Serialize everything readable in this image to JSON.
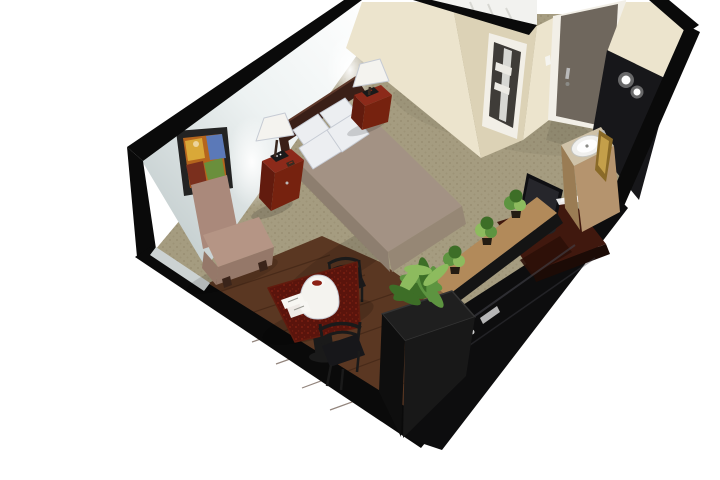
{
  "meta": {
    "title": "Isometric 3D cutaway rendering of a hotel guest room",
    "type": "3d-room-render"
  },
  "scene": {
    "description": "Top-down isometric cutaway of a hotel studio room: bed with headboard and lamps, lounge chair, framed art, dining table with two metal chairs on hardwood, plant wall with TV cabinet, vanity with sink, bathroom and entry door",
    "objects": [
      {
        "id": "room",
        "label": "Hotel guest room (isometric cutaway)"
      },
      {
        "id": "left-wall",
        "label": "Left wall"
      },
      {
        "id": "wall-art",
        "label": "Framed abstract painting"
      },
      {
        "id": "bathroom",
        "label": "Bathroom with doorway and shower"
      },
      {
        "id": "entry-door",
        "label": "Entry door with lever handle"
      },
      {
        "id": "bed",
        "label": "Bed with taupe coverlet, four white pillows, dark cherry headboard"
      },
      {
        "id": "nightstand-left",
        "label": "Cherry nightstand with table lamp and phone"
      },
      {
        "id": "nightstand-right",
        "label": "Cherry nightstand with table lamp"
      },
      {
        "id": "lounge-chair",
        "label": "Taupe armless lounge chair"
      },
      {
        "id": "dining-table",
        "label": "Dark wood table with white lamp and papers"
      },
      {
        "id": "dining-chair-1",
        "label": "Black metal ladder-back chair"
      },
      {
        "id": "dining-chair-2",
        "label": "Black metal ladder-back chair"
      },
      {
        "id": "floor-planter",
        "label": "Black floor planter with fern"
      },
      {
        "id": "console",
        "label": "Wood-top half wall with three potted plants"
      },
      {
        "id": "tv-cabinet",
        "label": "Black entertainment unit with flat-screen TV"
      },
      {
        "id": "vanity",
        "label": "Vanity with round sink and lighted mirror"
      },
      {
        "id": "carpet",
        "label": "Beige patterned carpet"
      },
      {
        "id": "hardwood-floor",
        "label": "Dark hardwood dining floor"
      }
    ],
    "colors": {
      "background": "#ffffff",
      "wallCut": "#0a0a0a",
      "wallLeftDark": "#bac5c6",
      "wallLeftLight": "#edf2f2",
      "wallLowInner": "#ccd2d2",
      "wallCream": "#ece4cd",
      "wallCreamShade": "#dcd2b6",
      "bathInterior": "#f2f2ef",
      "tileLine": "#d8d8d3",
      "bathDoorInterior": "#3f3c38",
      "towel": "#eceae4",
      "doorFrame": "#f2efe7",
      "door": "#6f675d",
      "doorHardware": "#b9b9b9",
      "wallPlate": "#f5f4ef",
      "carpet": "#a59c80",
      "carpetDot": "#8f8468",
      "hardwood": "#5a3722",
      "hardwoodSeam": "#3a2112",
      "headboard": "#3a1f17",
      "headboardHi": "#5f392b",
      "cherry": "#8c2a1a",
      "cherryDark": "#621b0e",
      "cherrySide": "#76220f",
      "pillow": "#eceef1",
      "pillowShade": "#c6cbd4",
      "bedspread": "#a39284",
      "bedspreadShade": "#8d7e6f",
      "bedspreadFoot": "#968775",
      "lampShade": "#f4f3ef",
      "lampStem": "#3a2a20",
      "lampOpening": "#8c2015",
      "lampTop": "#f8f8f6",
      "chairTaupe": "#aa897b",
      "chairTaupeLight": "#b59585",
      "chairTaupeShade": "#957869",
      "furnitureFoot": "#3a241a",
      "tableTop": "#5a140c",
      "tableSpeck": "#9c2c16",
      "metal": "#1a1a1a",
      "seatBlack": "#17171a",
      "gloss": "#0d0d0e",
      "glossHi": "#43434a",
      "credenzaWood": "#40180e",
      "credenzaEdge": "#1c0b06",
      "credenzaInner": "#2c0f08",
      "tvBack": "#0f0f12",
      "tvScreen": "#26262b",
      "tvDisc": "#232326",
      "consoleWood": "#b28a5a",
      "consoleWoodDark": "#8a6640",
      "consoleBase": "#141414",
      "planterDark": "#0e0e0e",
      "planterMid": "#181818",
      "planterRim": "#1f1f1f",
      "planterEdge": "#343434",
      "fern": "#5d9440",
      "fernDark": "#3d6e27",
      "fernLight": "#8dbb5e",
      "potDark": "#241c12",
      "vanityWood": "#b5946e",
      "vanityWoodDark": "#9a7c54",
      "counter": "#cfc2a8",
      "sink": "#f0f0ee",
      "sinkRim": "#c6c6c0",
      "sinkDrain": "#8a8a86",
      "gold": "#8a6a28",
      "goldLight": "#c49f4a",
      "mirrorBlack": "#17171a",
      "lightDot": "#ffffff",
      "artFrame": "#232323",
      "artBase": "#b5651d",
      "artBlue": "#5b79b8",
      "artYellow": "#d9a838",
      "artGreen": "#6a8f3c",
      "artRed": "#7a2f1d",
      "paper": "#f7f6f2",
      "paperLine": "#9a9a94",
      "shadow": "#000000"
    }
  }
}
